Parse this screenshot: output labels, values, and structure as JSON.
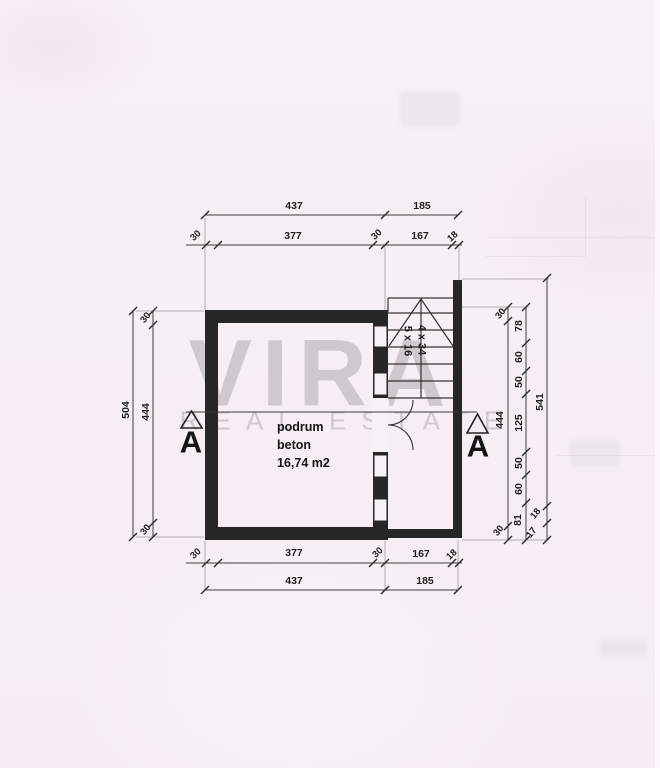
{
  "watermark": {
    "title": "VIRA",
    "subtitle": "REAL ESTATE"
  },
  "room_label": {
    "name": "podrum",
    "material": "beton",
    "area": "16,74 m2"
  },
  "stair": {
    "treads": "4 x 34",
    "risers": "5 x 16"
  },
  "section_markers": {
    "left": "A",
    "right": "A"
  },
  "dimensions": {
    "top_outer": [
      "437",
      "185"
    ],
    "top_inner": [
      "30",
      "377",
      "30",
      "167",
      "18"
    ],
    "bottom_inner": [
      "30",
      "377",
      "30",
      "167",
      "18"
    ],
    "bottom_outer": [
      "437",
      "185"
    ],
    "left_outer": [
      "504"
    ],
    "left_inner": [
      "30",
      "444",
      "30"
    ],
    "right_inner": [
      "30",
      "444",
      "30"
    ],
    "right_middle": [
      "78",
      "60",
      "50",
      "125",
      "50",
      "60",
      "81"
    ],
    "right_outer": [
      "541",
      "18",
      "17"
    ]
  },
  "colors": {
    "paper": "#f7f0f4",
    "ink": "#262626",
    "watermark": "#a8a3a7"
  }
}
